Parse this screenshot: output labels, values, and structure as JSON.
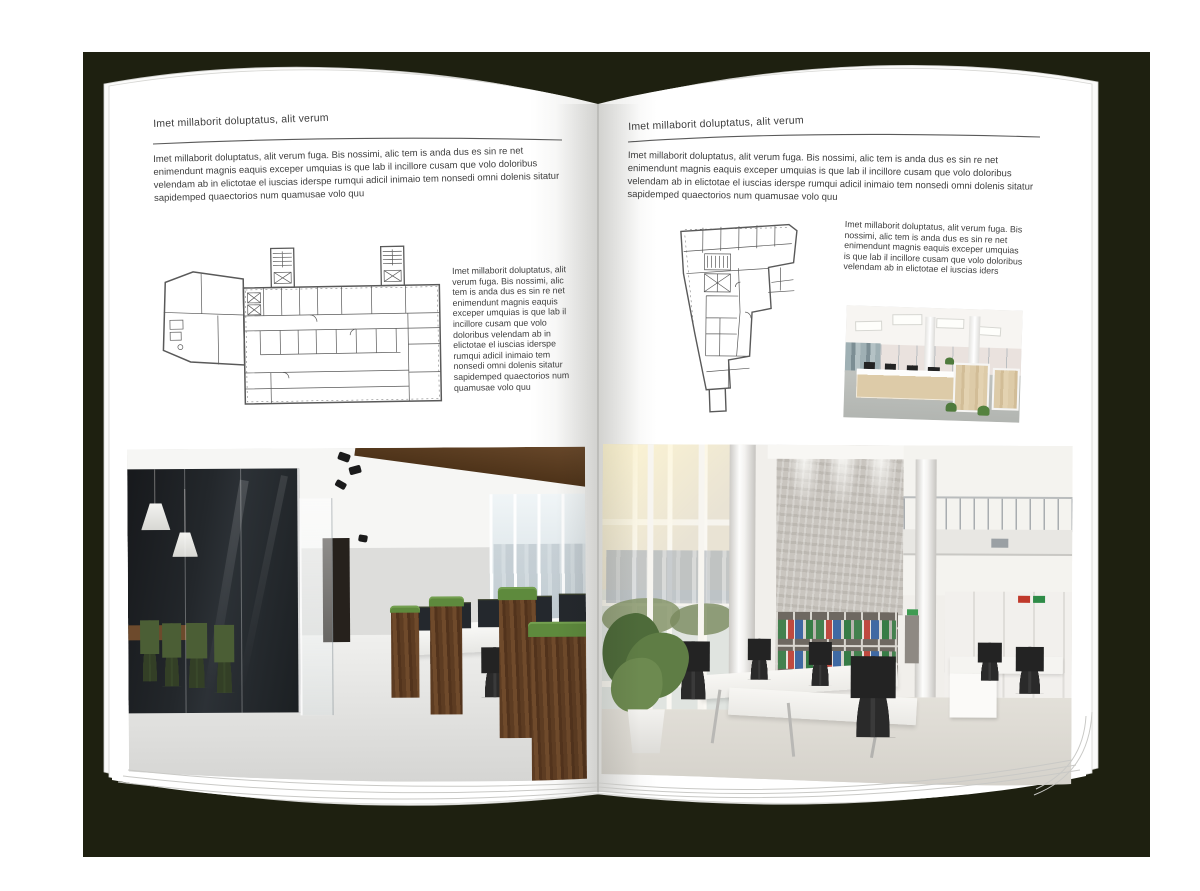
{
  "document": {
    "palette": {
      "backdrop": "#1e2010",
      "page": "#ffffff",
      "text": "#3e3e3e",
      "plan_line": "#474747",
      "wood": "#7b5231",
      "chair_green": "#4b5e35",
      "binder_green": "#44814f",
      "binder_red": "#bf4a40",
      "binder_blue": "#3f69a3"
    },
    "left_page": {
      "header": "Imet millaborit doluptatus, alit verum",
      "intro": "Imet millaborit doluptatus, alit verum fuga. Bis nossimi, alic tem is anda dus es sin re net enimendunt magnis eaquis exceper umquias is que lab il incillore cusam que volo doloribus velendam ab in elictotae el iuscias iderspe rumqui adicil inimaio tem nonsedi omni dolenis sitatur sapidemped quaectorios num quamusae volo quu",
      "floor_plan": {
        "description": "Wide building floor plan with two stair towers and angled left wing"
      },
      "side_text": "Imet millaborit doluptatus, alit verum fuga. Bis nossimi, alic tem is anda dus es sin re net enimendunt magnis eaquis exceper umquias is que lab il incillore cusam que volo doloribus velendam ab in elictotae el iuscias iderspe rumqui adicil inimaio tem nonsedi omni dolenis sitatur sapidemped quaectorios num quamusae volo quu",
      "photo": {
        "description": "Office interior with dark glass meeting room, green chairs, wood wall and desk row"
      }
    },
    "right_page": {
      "header": "Imet millaborit doluptatus, alit verum",
      "intro": "Imet millaborit doluptatus, alit verum fuga. Bis nossimi, alic tem is anda dus es sin re net enimendunt magnis eaquis exceper umquias is que lab il incillore cusam que volo doloribus velendam ab in elictotae el iuscias iderspe rumqui adicil inimaio tem nonsedi omni dolenis sitatur sapidemped quaectorios num quamusae volo quu",
      "floor_plan": {
        "description": "Irregular triangular building floor plan with bottom stem"
      },
      "side_text": "Imet millaborit doluptatus, alit verum fuga. Bis nossimi, alic tem is anda dus es sin re net enimendunt magnis eaquis exceper umquias is que lab il incillore cusam que volo doloribus velendam ab in elictotae el iuscias iders",
      "photo_small": {
        "description": "Bright open-plan office with light wood workstations and black chairs"
      },
      "photo_large": {
        "description": "Double-height white office with window wall, concrete feature wall, binder shelves and plant"
      }
    }
  }
}
